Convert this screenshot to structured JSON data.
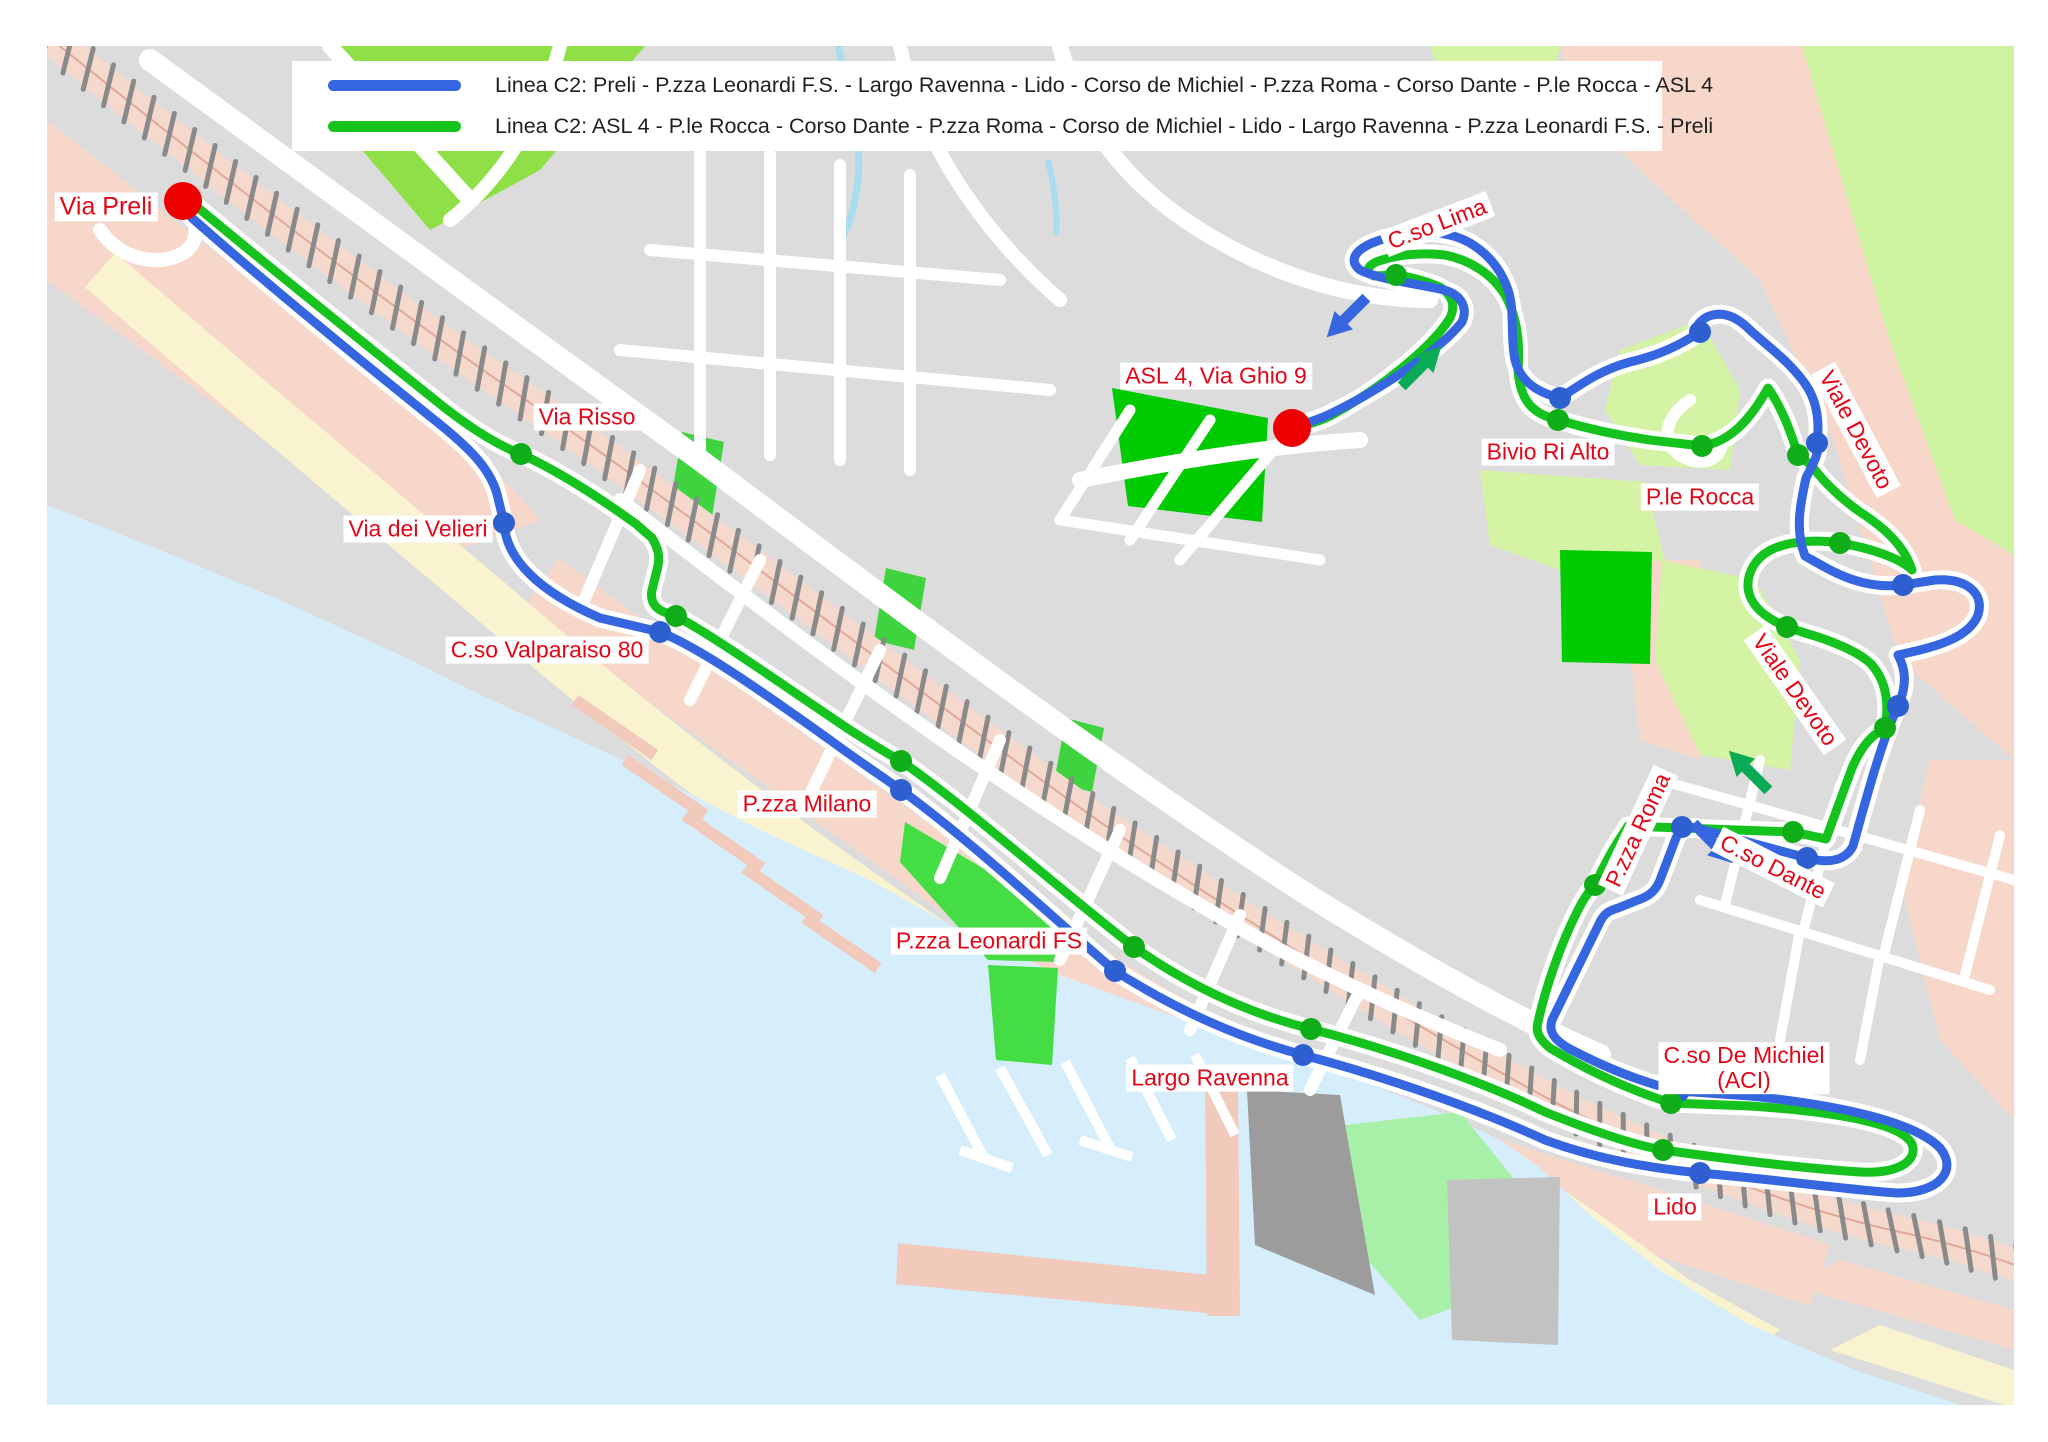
{
  "legend": {
    "items": [
      {
        "color": "#3566df",
        "label": "Linea C2: Preli - P.zza Leonardi F.S. - Largo Ravenna - Lido - Corso de Michiel - P.zza Roma - Corso Dante - P.le Rocca - ASL 4"
      },
      {
        "color": "#16c31e",
        "label": "Linea C2: ASL 4 - P.le Rocca - Corso Dante - P.zza Roma - Corso de Michiel - Lido - Largo Ravenna - P.zza Leonardi F.S. - Preli"
      }
    ]
  },
  "map": {
    "colors": {
      "sea": "#d6eefb",
      "land": "#dcdcdc",
      "road": "#ffffff",
      "urban_pink": "#f7d7ca",
      "beach": "#faf3cf",
      "park_bright": "#3fd43f",
      "park_vivid": "#00ca00",
      "park_pale": "#d4f3a5",
      "park_ul": "#8fe046",
      "park_lido": "#a8f0a8",
      "railway_fill": "#f5d9cd",
      "railway_tick": "#8a8a8a",
      "route_blue": "#3566df",
      "route_green": "#16c31e",
      "stop_blue": "#2e5fd0",
      "stop_green": "#0fae19",
      "endpoint_red": "#ee0000",
      "label_red": "#e30617",
      "arrow_green": "#0bab55",
      "pier_pink": "#f2cabc"
    },
    "endpoints": [
      {
        "name": "Via Preli",
        "x": 183,
        "y": 201
      },
      {
        "name": "ASL 4, Via Ghio 9",
        "x": 1292,
        "y": 428
      }
    ],
    "stops": [
      {
        "name": "Via Risso",
        "line": "green",
        "x": 521,
        "y": 454
      },
      {
        "name": "Via dei Velieri",
        "line": "blue",
        "x": 504,
        "y": 523
      },
      {
        "name": "C.so Valparaiso 80",
        "line": "green",
        "x": 676,
        "y": 616
      },
      {
        "name": "C.so Valparaiso 80",
        "line": "blue",
        "x": 660,
        "y": 632
      },
      {
        "name": "P.zza Milano",
        "line": "green",
        "x": 901,
        "y": 761
      },
      {
        "name": "P.zza Milano",
        "line": "blue",
        "x": 901,
        "y": 790
      },
      {
        "name": "P.zza Leonardi FS",
        "line": "green",
        "x": 1134,
        "y": 947
      },
      {
        "name": "P.zza Leonardi FS",
        "line": "blue",
        "x": 1115,
        "y": 971
      },
      {
        "name": "Largo Ravenna",
        "line": "green",
        "x": 1311,
        "y": 1029
      },
      {
        "name": "Largo Ravenna",
        "line": "blue",
        "x": 1303,
        "y": 1055
      },
      {
        "name": "Lido",
        "line": "green",
        "x": 1663,
        "y": 1150
      },
      {
        "name": "Lido",
        "line": "blue",
        "x": 1700,
        "y": 1173
      },
      {
        "name": "C.so De Michiel (ACI)",
        "line": "blue",
        "x": 1679,
        "y": 1091
      },
      {
        "name": "C.so De Michiel (ACI)",
        "line": "green",
        "x": 1671,
        "y": 1103
      },
      {
        "name": "P.zza Roma",
        "line": "green",
        "x": 1595,
        "y": 885
      },
      {
        "name": "P.zza Roma",
        "line": "blue",
        "x": 1682,
        "y": 827
      },
      {
        "name": "C.so Dante",
        "line": "green",
        "x": 1793,
        "y": 832
      },
      {
        "name": "C.so Dante",
        "line": "blue",
        "x": 1807,
        "y": 858
      },
      {
        "name": "Viale Devoto",
        "line": "green",
        "x": 1885,
        "y": 728
      },
      {
        "name": "Viale Devoto",
        "line": "blue",
        "x": 1898,
        "y": 706
      },
      {
        "name": "Viale Devoto",
        "line": "green",
        "x": 1787,
        "y": 627
      },
      {
        "name": "Viale Devoto",
        "line": "green",
        "x": 1840,
        "y": 543
      },
      {
        "name": "Viale Devoto",
        "line": "blue",
        "x": 1903,
        "y": 585
      },
      {
        "name": "Viale Devoto",
        "line": "blue",
        "x": 1817,
        "y": 443
      },
      {
        "name": "Viale Devoto",
        "line": "green",
        "x": 1798,
        "y": 455
      },
      {
        "name": "P.le Rocca",
        "line": "blue",
        "x": 1700,
        "y": 332
      },
      {
        "name": "P.le Rocca",
        "line": "green",
        "x": 1702,
        "y": 446
      },
      {
        "name": "Bivio Ri Alto",
        "line": "blue",
        "x": 1560,
        "y": 398
      },
      {
        "name": "Bivio Ri Alto",
        "line": "green",
        "x": 1558,
        "y": 420
      },
      {
        "name": "C.so Lima",
        "line": "green",
        "x": 1396,
        "y": 275
      }
    ],
    "labels": [
      {
        "text": "Via Preli",
        "x": 106,
        "y": 207,
        "rot": 0
      },
      {
        "text": "Via Risso",
        "x": 587,
        "y": 417,
        "rot": 0
      },
      {
        "text": "Via dei Velieri",
        "x": 418,
        "y": 529,
        "rot": 0
      },
      {
        "text": "C.so Valparaiso 80",
        "x": 547,
        "y": 650,
        "rot": 0
      },
      {
        "text": "P.zza Milano",
        "x": 807,
        "y": 804,
        "rot": 0
      },
      {
        "text": "P.zza Leonardi FS",
        "x": 989,
        "y": 941,
        "rot": 0
      },
      {
        "text": "Largo Ravenna",
        "x": 1210,
        "y": 1078,
        "rot": 0
      },
      {
        "text": "Lido",
        "x": 1675,
        "y": 1207,
        "rot": 0
      },
      {
        "text": "C.so De Michiel\n(ACI)",
        "x": 1744,
        "y": 1068,
        "rot": 0
      },
      {
        "text": "P.zza Roma",
        "x": 1638,
        "y": 830,
        "rot": -65
      },
      {
        "text": "C.so Dante",
        "x": 1773,
        "y": 867,
        "rot": 27
      },
      {
        "text": "Viale Devoto",
        "x": 1856,
        "y": 430,
        "rot": 62
      },
      {
        "text": "Viale Devoto",
        "x": 1795,
        "y": 690,
        "rot": 55
      },
      {
        "text": "P.le Rocca",
        "x": 1700,
        "y": 497,
        "rot": 0
      },
      {
        "text": "Bivio Ri Alto",
        "x": 1548,
        "y": 452,
        "rot": 0
      },
      {
        "text": "C.so Lima",
        "x": 1437,
        "y": 224,
        "rot": -21
      },
      {
        "text": "ASL 4, Via Ghio 9",
        "x": 1216,
        "y": 376,
        "rot": 0
      }
    ],
    "arrows": [
      {
        "name": "blue-direction-arrow-sw",
        "color": "#3566df",
        "x": 1348,
        "y": 316,
        "angle": 135
      },
      {
        "name": "green-direction-arrow-ne",
        "color": "#0bab55",
        "x": 1420,
        "y": 368,
        "angle": -45
      },
      {
        "name": "green-direction-arrow-nw",
        "color": "#0bab55",
        "x": 1750,
        "y": 772,
        "angle": -135
      },
      {
        "name": "blue-direction-arrow-se",
        "color": "#3566df",
        "x": 1712,
        "y": 842,
        "angle": 45
      }
    ]
  }
}
